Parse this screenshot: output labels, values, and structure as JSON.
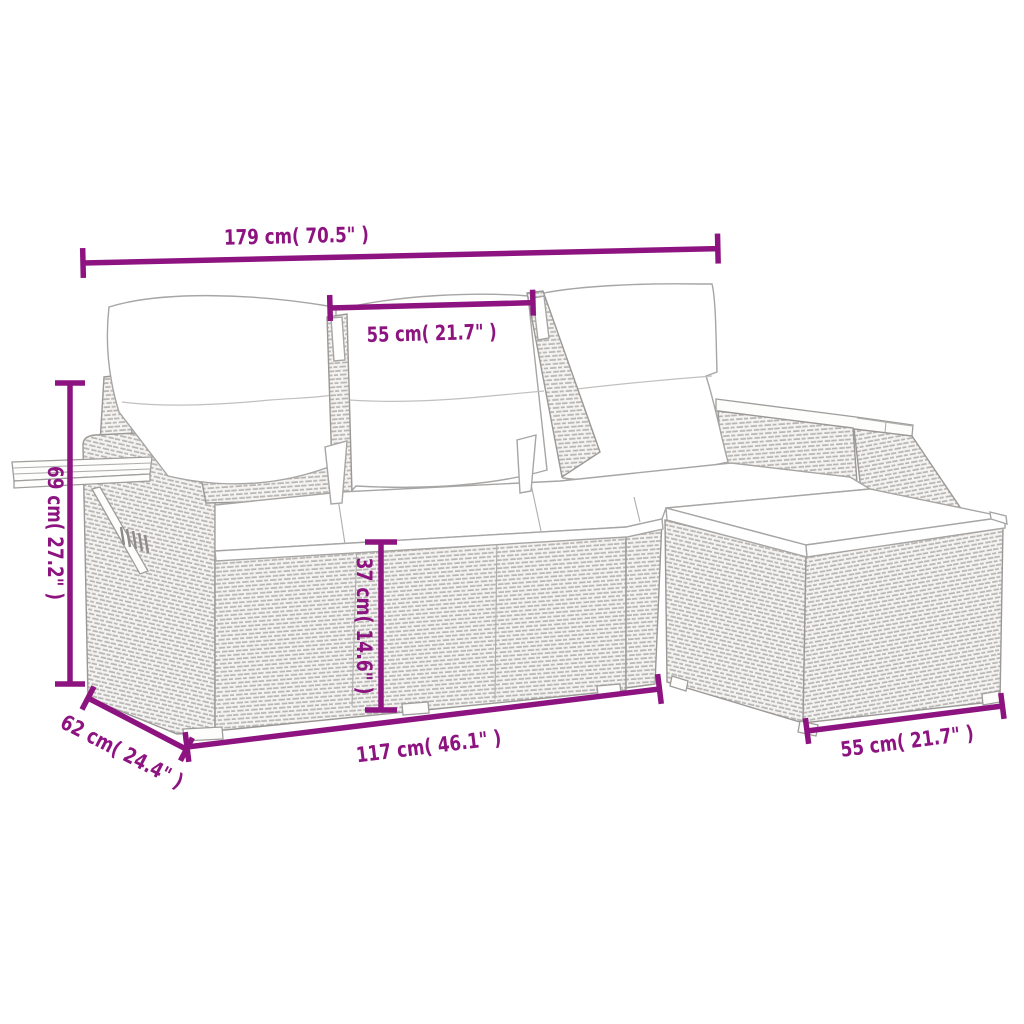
{
  "figure": {
    "background": "#ffffff",
    "subject": "rattan-garden-sofa-set-with-footstool-dimension-diagram"
  },
  "colors": {
    "accent": "#8D1480",
    "outline": "#9b9896"
  },
  "dimension_labels": {
    "overall_width": "179 cm( 70.5\" )",
    "back_cushion_width": "55 cm( 21.7\" )",
    "backrest_height": "69 cm( 27.2\" )",
    "seat_depth": "62 cm( 24.4\" )",
    "seat_height": "37 cm( 14.6\" )",
    "front_length": "117 cm( 46.1\" )",
    "footstool_width": "55 cm( 21.7\" )"
  }
}
